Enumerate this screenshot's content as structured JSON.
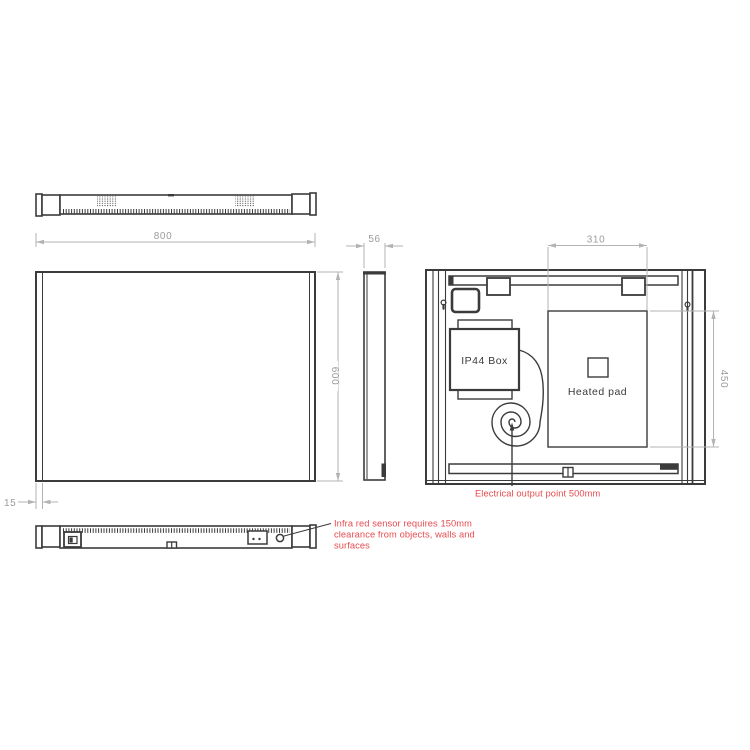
{
  "dims": {
    "width": "800",
    "depth": "56",
    "height": "600",
    "pad_width": "310",
    "pad_height": "450",
    "frame_offset": "15"
  },
  "labels": {
    "ip44_box": "IP44 Box",
    "heated_pad": "Heated pad"
  },
  "annotations": {
    "electrical_output": "Electrical output point 500mm",
    "ir_sensor_line1": "Infra red sensor requires 150mm",
    "ir_sensor_line2": "clearance from objects, walls and",
    "ir_sensor_line3": "surfaces"
  },
  "colors": {
    "line": "#3b3b3b",
    "dim_line": "#b3b3b3",
    "dim_text": "#9c9c9c",
    "annotation_red": "#e84a4e",
    "background": "#ffffff"
  }
}
